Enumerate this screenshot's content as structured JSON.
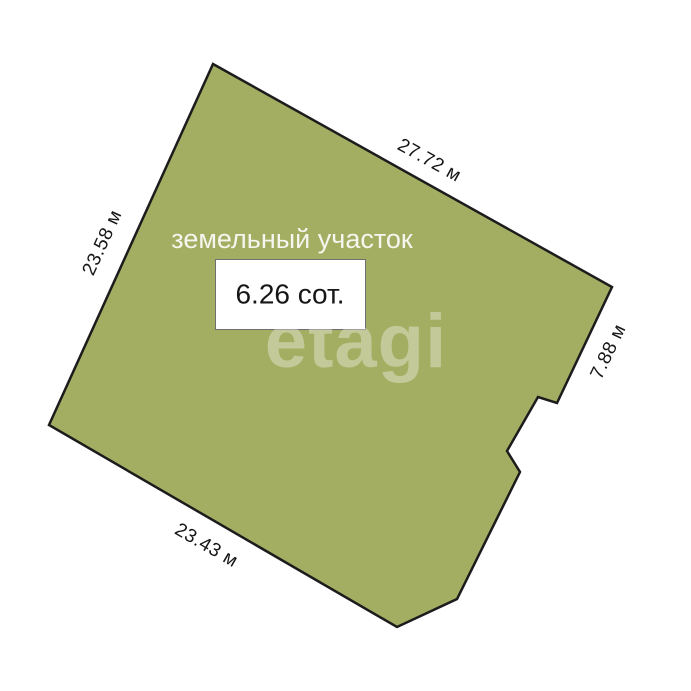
{
  "diagram": {
    "type": "land-plot-plan",
    "plot_label": "земельный участок",
    "area_value": "6.26 сот.",
    "watermark": "etagi",
    "dimensions": {
      "top": "27.72 м",
      "left": "23.58 м",
      "right": "7.88 м",
      "bottom": "23.43 м"
    },
    "polygon_points": "213,64 612,287 557,403 538,397 507,451 520,472 457,599 397,627 49,425",
    "colors": {
      "plot_fill": "#a4ae63",
      "plot_stroke": "#1c1c1c",
      "plot_label_text": "#f6f6ee",
      "dimension_text": "#161616",
      "area_box_fill": "#ffffff",
      "area_box_border": "#6f6f6f"
    }
  }
}
